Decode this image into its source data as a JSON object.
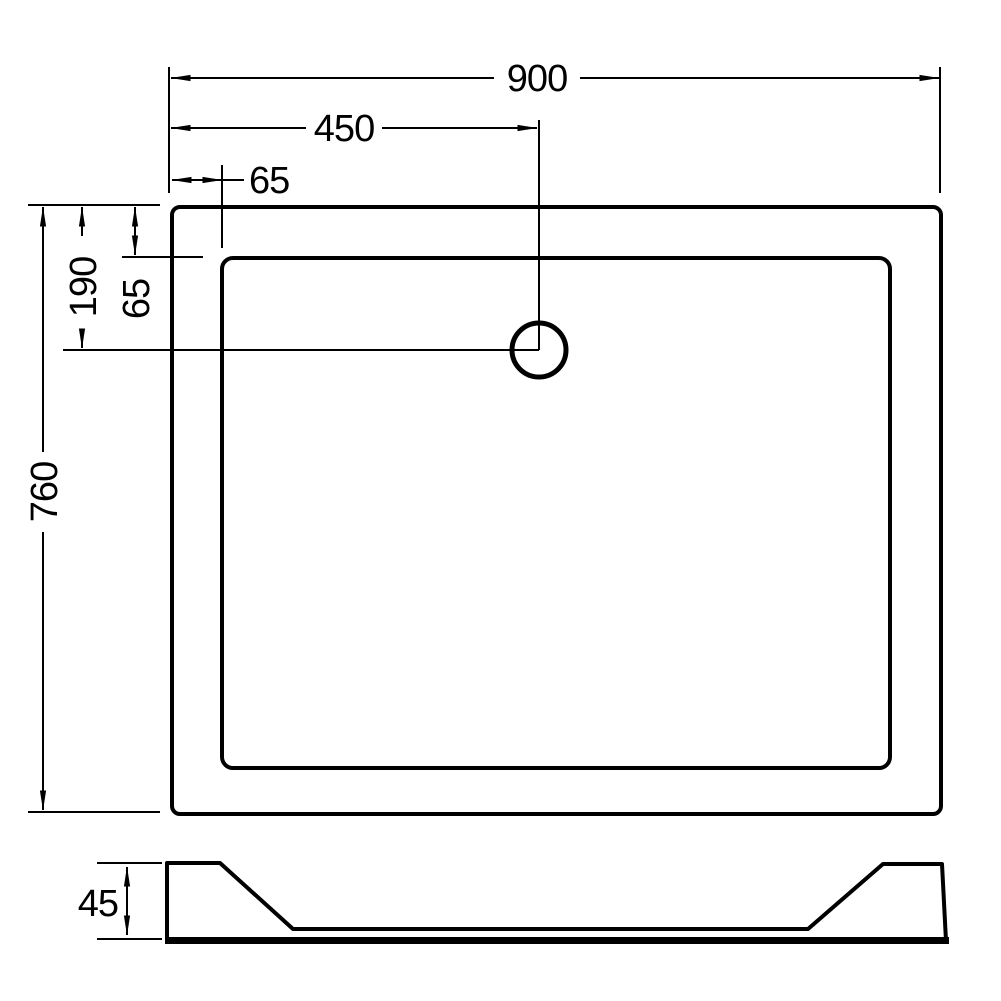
{
  "diagram": {
    "type": "technical-drawing",
    "subject": "rectangular-shower-tray",
    "background_color": "#ffffff",
    "line_color": "#000000",
    "plan_view": {
      "dim_overall_width": "900",
      "dim_drain_offset_x": "450",
      "dim_rim_inset_x": "65",
      "dim_overall_depth": "760",
      "dim_drain_offset_y": "190",
      "dim_rim_inset_y": "65"
    },
    "profile_view": {
      "dim_tray_height": "45"
    }
  }
}
